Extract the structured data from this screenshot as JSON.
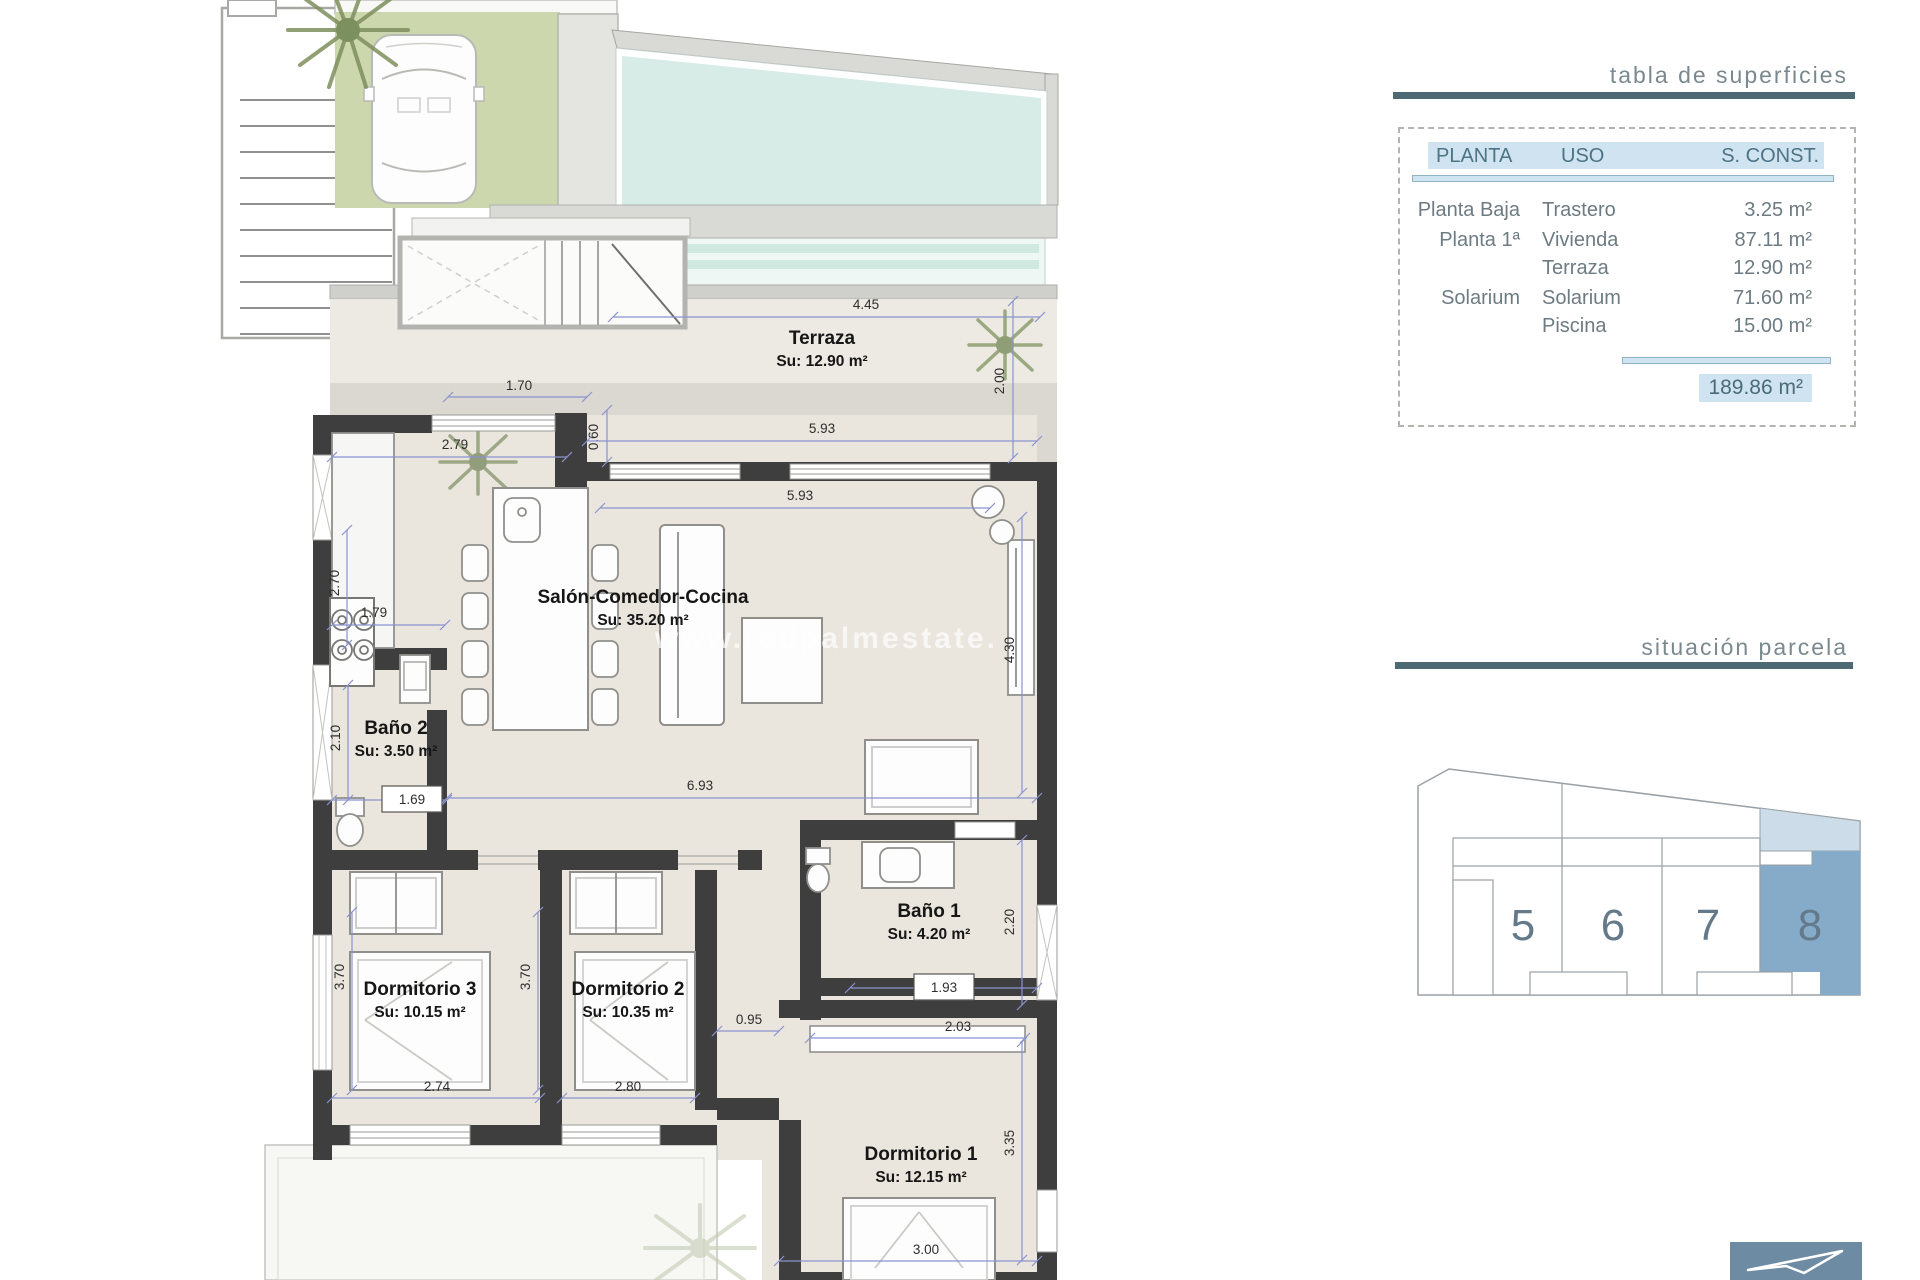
{
  "watermark": "www.redpalmestate.",
  "surface_table": {
    "title": "tabla de superficies",
    "headers": [
      "PLANTA",
      "USO",
      "S. CONST."
    ],
    "rows": [
      {
        "planta": "Planta Baja",
        "uso": "Trastero",
        "sconst": "3.25 m²"
      },
      {
        "planta": "Planta 1ª",
        "uso": "Vivienda",
        "sconst": "87.11 m²"
      },
      {
        "planta": "",
        "uso": "Terraza",
        "sconst": "12.90 m²"
      },
      {
        "planta": "Solarium",
        "uso": "Solarium",
        "sconst": "71.60 m²"
      },
      {
        "planta": "",
        "uso": "Piscina",
        "sconst": "15.00 m²"
      }
    ],
    "total": "189.86 m²",
    "accent_color": "#cfe4f0",
    "rule_color": "#4d6a74"
  },
  "parcel": {
    "title": "situación parcela",
    "plots": [
      "5",
      "6",
      "7",
      "8"
    ],
    "highlighted": "8",
    "highlight_color": "#85abc9",
    "highlight_band_color": "#ccdde9"
  },
  "logo": {
    "bg_color": "#6d8ba3"
  },
  "plan": {
    "rooms": [
      {
        "name": "Terraza",
        "area": "Su: 12.90 m²",
        "x": 822,
        "y": 344
      },
      {
        "name": "Salón-Comedor-Cocina",
        "area": "Su: 35.20 m²",
        "x": 643,
        "y": 603
      },
      {
        "name": "Baño 2",
        "area": "Su: 3.50 m²",
        "x": 396,
        "y": 734
      },
      {
        "name": "Dormitorio 3",
        "area": "Su: 10.15 m²",
        "x": 420,
        "y": 995
      },
      {
        "name": "Dormitorio 2",
        "area": "Su: 10.35 m²",
        "x": 628,
        "y": 995
      },
      {
        "name": "Baño 1",
        "area": "Su: 4.20 m²",
        "x": 929,
        "y": 917
      },
      {
        "name": "Dormitorio 1",
        "area": "Su: 12.15 m²",
        "x": 921,
        "y": 1160
      }
    ],
    "dims": [
      {
        "t": "4.45",
        "x": 866,
        "y": 309,
        "rot": 0,
        "box": 0,
        "line": [
          613,
          317,
          1040,
          317
        ]
      },
      {
        "t": "2.00",
        "x": 1004,
        "y": 381,
        "rot": 1,
        "box": 0,
        "line": [
          1013,
          301,
          1013,
          458
        ]
      },
      {
        "t": "1.70",
        "x": 519,
        "y": 390,
        "rot": 0,
        "box": 0,
        "line": [
          448,
          397,
          587,
          397
        ]
      },
      {
        "t": "0.60",
        "x": 598,
        "y": 437,
        "rot": 1,
        "box": 0,
        "line": [
          607,
          410,
          607,
          462
        ]
      },
      {
        "t": "5.93",
        "x": 822,
        "y": 433,
        "rot": 0,
        "box": 0,
        "line": [
          587,
          441,
          1037,
          441
        ]
      },
      {
        "t": "5.93",
        "x": 800,
        "y": 500,
        "rot": 0,
        "box": 0,
        "line": [
          600,
          508,
          990,
          508
        ]
      },
      {
        "t": "2.79",
        "x": 455,
        "y": 449,
        "rot": 0,
        "box": 0,
        "line": [
          332,
          457,
          567,
          457
        ]
      },
      {
        "t": "2.70",
        "x": 339,
        "y": 583,
        "rot": 1,
        "box": 0,
        "line": [
          347,
          530,
          347,
          645
        ]
      },
      {
        "t": "1.79",
        "x": 374,
        "y": 617,
        "rot": 0,
        "box": 0,
        "line": [
          332,
          625,
          445,
          625
        ]
      },
      {
        "t": "2.10",
        "x": 340,
        "y": 738,
        "rot": 1,
        "box": 0,
        "line": [
          348,
          685,
          348,
          800
        ]
      },
      {
        "t": "1.69",
        "x": 412,
        "y": 804,
        "rot": 0,
        "box": 1,
        "line": [
          332,
          800,
          447,
          800
        ]
      },
      {
        "t": "6.93",
        "x": 700,
        "y": 790,
        "rot": 0,
        "box": 0,
        "line": [
          447,
          798,
          1037,
          798
        ]
      },
      {
        "t": "4.30",
        "x": 1014,
        "y": 650,
        "rot": 1,
        "box": 0,
        "line": [
          1022,
          517,
          1022,
          793
        ]
      },
      {
        "t": "2.20",
        "x": 1014,
        "y": 922,
        "rot": 1,
        "box": 0,
        "line": [
          1022,
          840,
          1022,
          1005
        ]
      },
      {
        "t": "0.95",
        "x": 749,
        "y": 1024,
        "rot": 0,
        "box": 0,
        "line": [
          717,
          1031,
          779,
          1031
        ]
      },
      {
        "t": "2.03",
        "x": 958,
        "y": 1031,
        "rot": 0,
        "box": 0,
        "line": [
          810,
          1038,
          1025,
          1038
        ]
      },
      {
        "t": "1.93",
        "x": 944,
        "y": 992,
        "rot": 0,
        "box": 1,
        "line": [
          850,
          988,
          1037,
          988
        ]
      },
      {
        "t": "3.70",
        "x": 344,
        "y": 977,
        "rot": 1,
        "box": 0,
        "line": [
          352,
          912,
          352,
          1090
        ]
      },
      {
        "t": "3.70",
        "x": 530,
        "y": 977,
        "rot": 1,
        "box": 0,
        "line": [
          538,
          912,
          538,
          1090
        ]
      },
      {
        "t": "2.74",
        "x": 437,
        "y": 1091,
        "rot": 0,
        "box": 0,
        "line": [
          332,
          1098,
          540,
          1098
        ]
      },
      {
        "t": "2.80",
        "x": 628,
        "y": 1091,
        "rot": 0,
        "box": 0,
        "line": [
          562,
          1098,
          695,
          1098
        ]
      },
      {
        "t": "3.35",
        "x": 1014,
        "y": 1143,
        "rot": 1,
        "box": 0,
        "line": [
          1022,
          1042,
          1022,
          1260
        ]
      },
      {
        "t": "3.00",
        "x": 926,
        "y": 1254,
        "rot": 0,
        "box": 0,
        "line": [
          779,
          1261,
          1037,
          1261
        ]
      }
    ]
  }
}
